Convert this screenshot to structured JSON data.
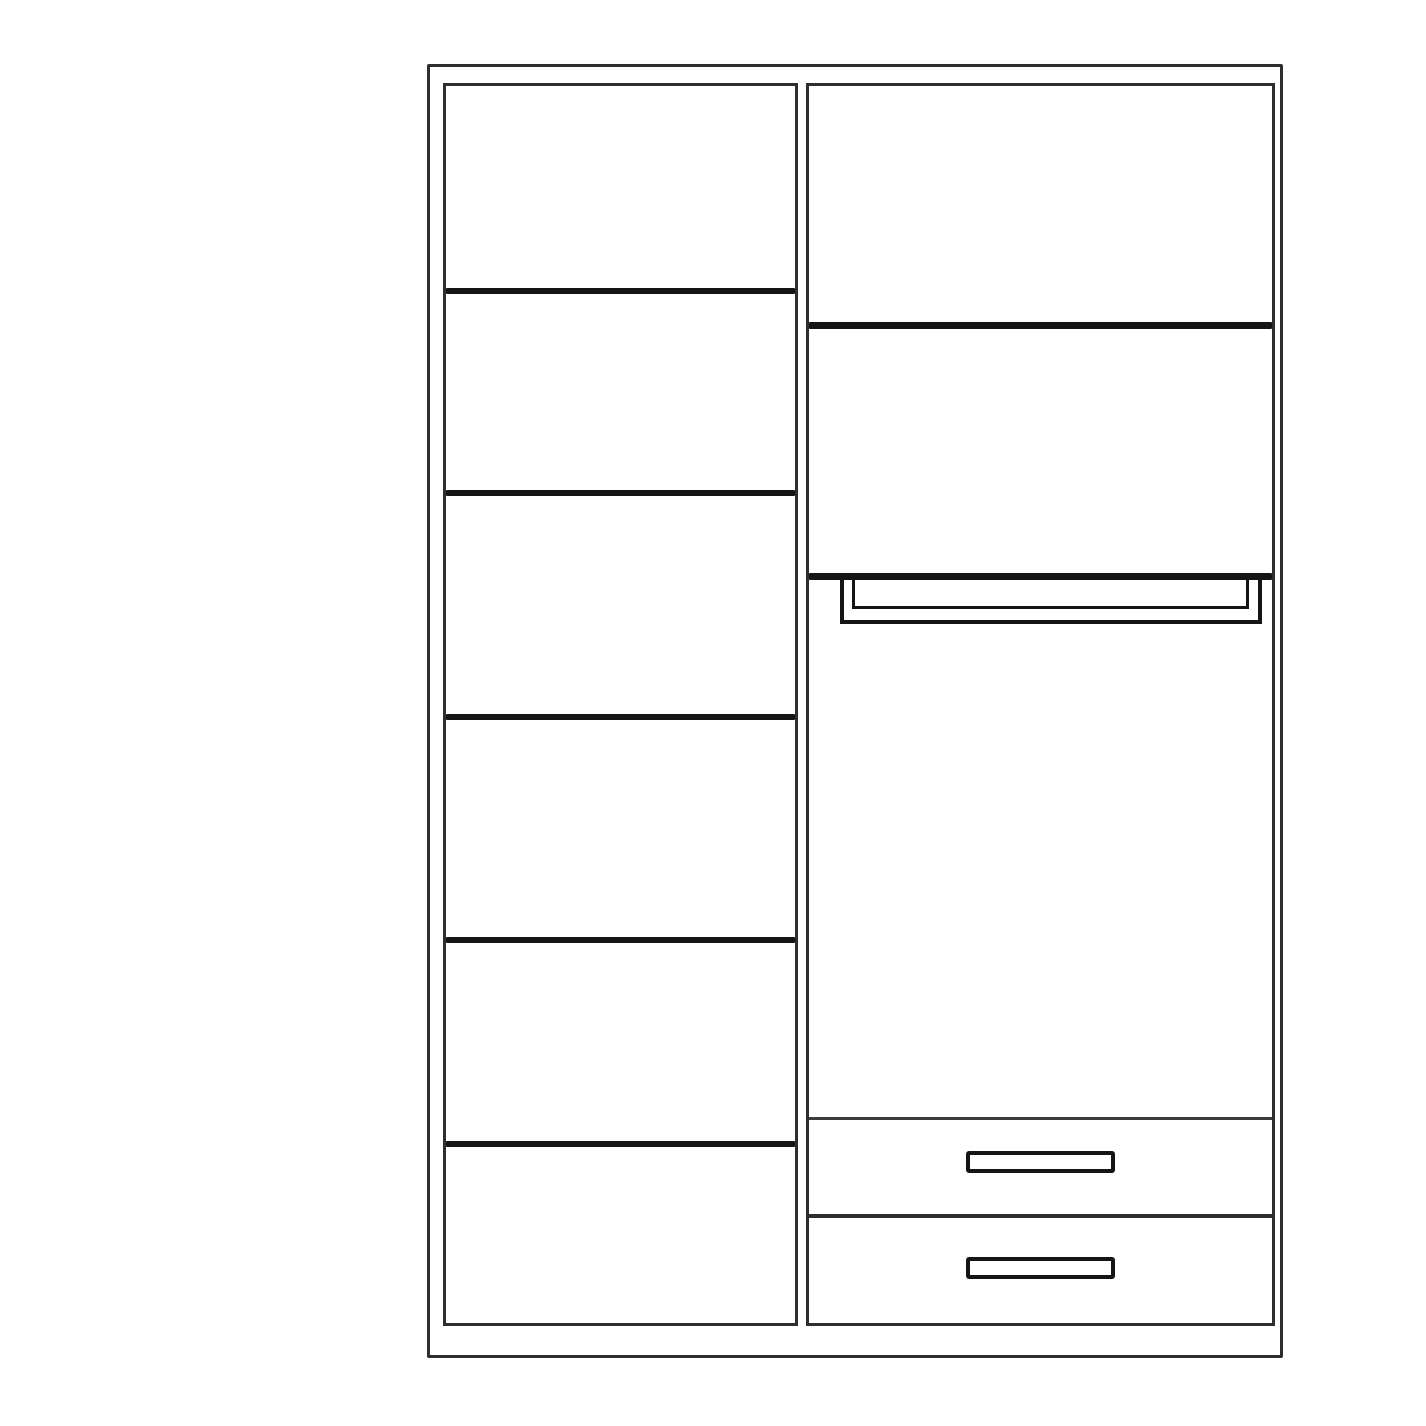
{
  "meta": {
    "description": "Black-and-white line drawing of a two-section wardrobe interior layout",
    "contains_text": false
  },
  "colors": {
    "background": "#ffffff",
    "frame_line": "#2e2e2e",
    "shelf_line": "#151515",
    "thin_line": "#3b3b3b"
  },
  "wardrobe": {
    "left_section": {
      "type": "shelf-column",
      "shelf_lines": 5,
      "compartments": 6
    },
    "right_section": {
      "type": "hanging-and-drawers-column",
      "upper_shelf_lines": 2,
      "hanging_rail": true,
      "drawers": 2,
      "drawer_handles": 2
    }
  }
}
